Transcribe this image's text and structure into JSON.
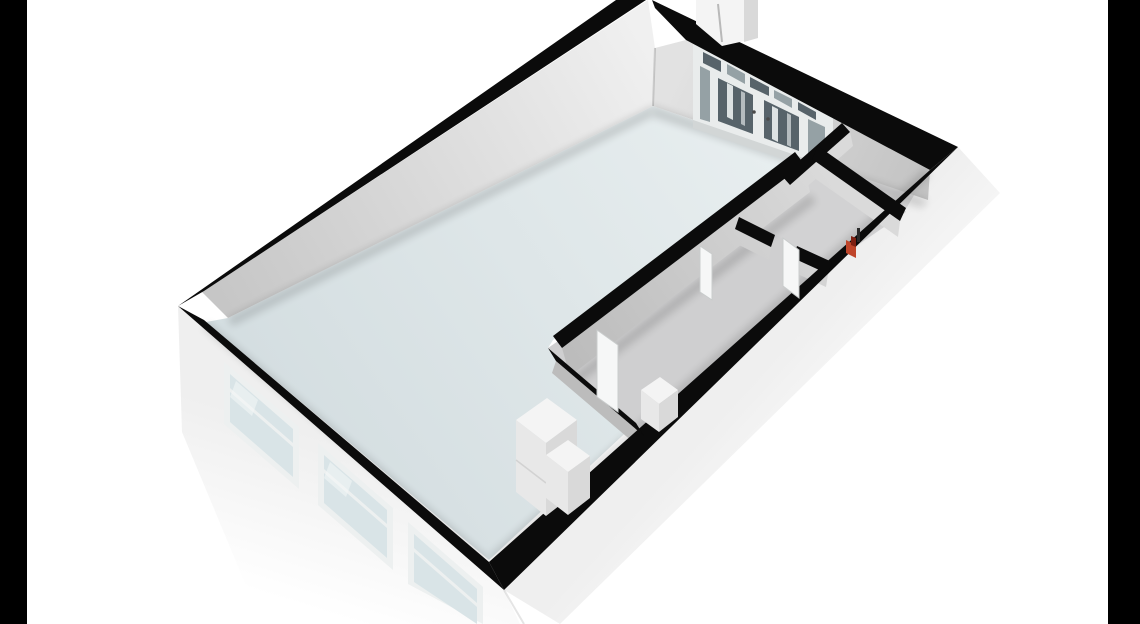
{
  "scene": {
    "type": "3d-floorplan-render",
    "description": "Isometric 3D floor plan of a studio apartment viewed from above, floating on a white background with black letterbox bars on both sides",
    "rooms": [
      {
        "name": "living-room",
        "floor": "pale blue-gray"
      },
      {
        "name": "corridor",
        "floor": "gray"
      },
      {
        "name": "bathroom",
        "floor": "gray"
      },
      {
        "name": "corner-closet",
        "floor": "gray"
      }
    ],
    "features": [
      "entrance-double-door-with-sidelights-and-transom",
      "exterior-vestibule-block",
      "three-facade-windows",
      "kitchen-cabinet-boxes",
      "open-interior-door-leaves",
      "red-accent-object"
    ]
  },
  "colors": {
    "bar": "#000000",
    "bg": "#ffffff",
    "wallCut": "#0b0b0b",
    "living1": "#d3dde0",
    "living2": "#eaf0f1",
    "corridorFloor": "#cfcfd0",
    "bathFloor": "#d2d2d3",
    "wcFloor": "#d7d7d8",
    "nwFace1": "#c6c6c6",
    "nwFace2": "#f0f0f0",
    "neFace1": "#e2e2e2",
    "neFace2": "#c2c2c2",
    "intFace1": "#bcbcbc",
    "intFace2": "#dadada",
    "extFace1": "#efefef",
    "extFace2": "#ffffff",
    "frameWhite": "#edf0f0",
    "doorBase": "#e9ecec",
    "threshold": "#d2d6d6",
    "glassDark": "#57636a",
    "glassMid": "#95a1a5",
    "glassPale": "#d9e4e7",
    "glassStreak": "#f4f8f8",
    "boxTop": "#f4f4f4",
    "boxFront": "#e8e8e8",
    "boxSide": "#d9d9d9",
    "leafWhite": "#f6f7f7",
    "leafEdge": "#c9cccc",
    "red1": "#bf452a",
    "red2": "#7e2012",
    "shadow": "#000000"
  }
}
